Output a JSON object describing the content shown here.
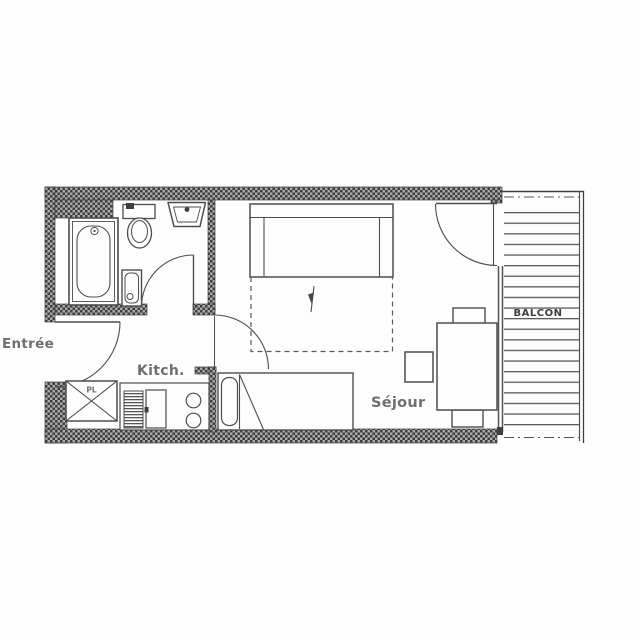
{
  "labels": {
    "entrance": "Entrée",
    "kitchen": "Kitch.",
    "living_room": "Séjour",
    "balcony": "BALCON",
    "closet": "PL"
  },
  "colors": {
    "background": "#fdfdfd",
    "wall_hatch_dark": "#3e3e3e",
    "wall_hatch_light": "#ababab",
    "outline": "#4d4d4d",
    "room_label": "#6f6f6f",
    "balcony_label": "#3f3f3f"
  },
  "icons": [
    "bathtub-icon",
    "toilet-icon",
    "washbasin-icon",
    "shower-tray-icon",
    "door-swing-icon",
    "wardrobe-icon",
    "kitchen-counter-icon",
    "fridge-vent-icon",
    "oven-icon",
    "hob-burners-icon",
    "single-bed-icon",
    "sofa-bed-icon",
    "bed-extension-icon",
    "pullout-arrow-icon",
    "stool-icon",
    "dining-table-icon",
    "chair-icon",
    "balcony-decking-icon"
  ]
}
